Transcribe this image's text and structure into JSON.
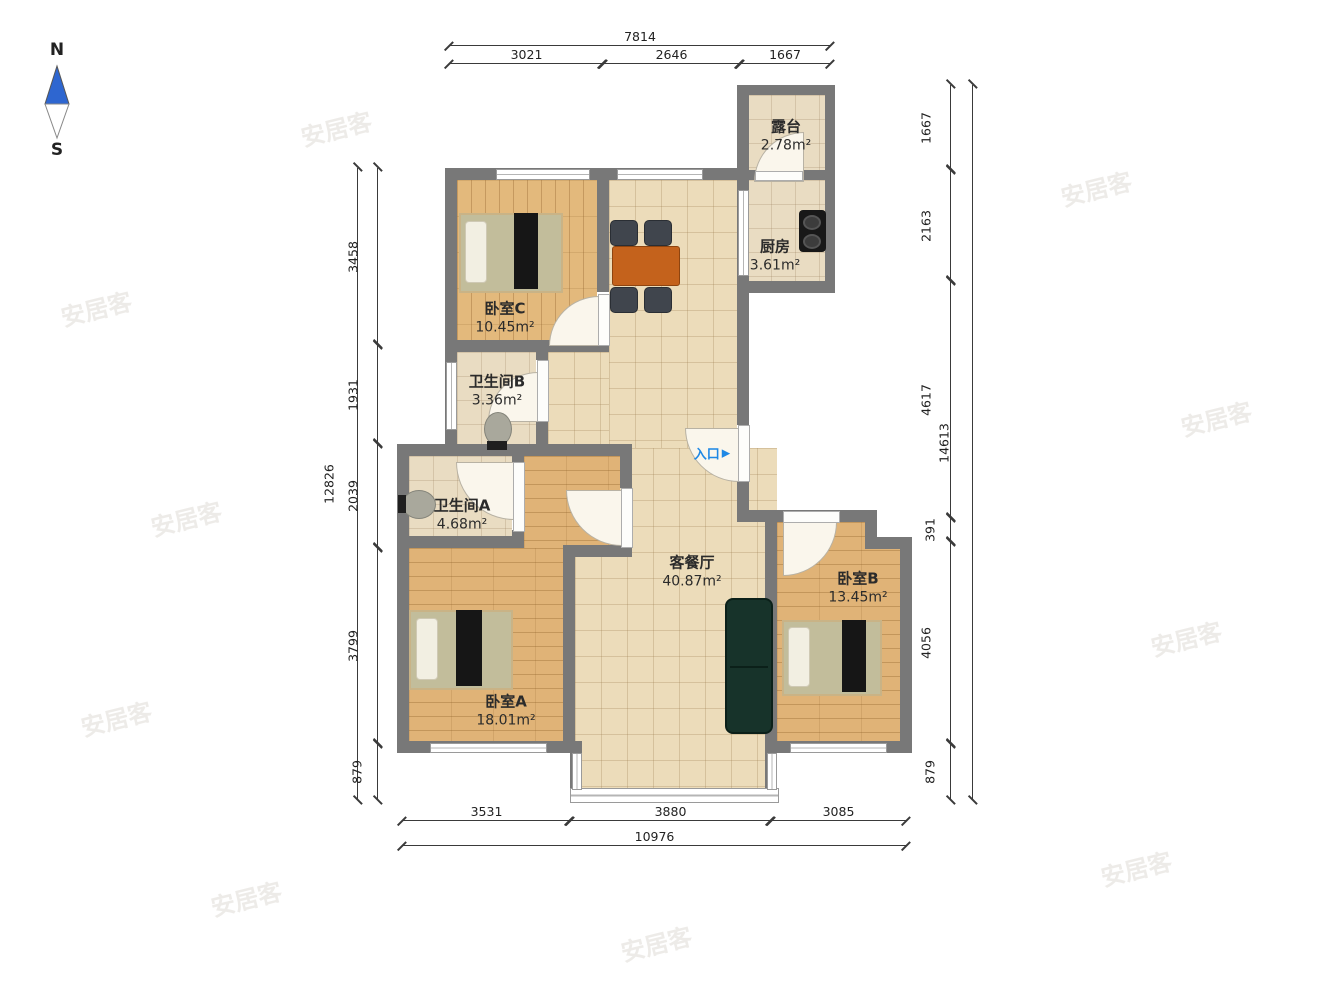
{
  "compass": {
    "north": "N",
    "south": "S"
  },
  "entrance": {
    "label": "入口",
    "arrow": "▶",
    "color": "#1e88e5"
  },
  "rooms": [
    {
      "id": "terrace",
      "name": "露台",
      "area": "2.78m²"
    },
    {
      "id": "kitchen",
      "name": "厨房",
      "area": "3.61m²"
    },
    {
      "id": "bedroomC",
      "name": "卧室C",
      "area": "10.45m²"
    },
    {
      "id": "bathB",
      "name": "卫生间B",
      "area": "3.36m²"
    },
    {
      "id": "bathA",
      "name": "卫生间A",
      "area": "4.68m²"
    },
    {
      "id": "living",
      "name": "客餐厅",
      "area": "40.87m²"
    },
    {
      "id": "bedroomB",
      "name": "卧室B",
      "area": "13.45m²"
    },
    {
      "id": "bedroomA",
      "name": "卧室A",
      "area": "18.01m²"
    }
  ],
  "dimensions": {
    "top": {
      "total": "7814",
      "segments": [
        "3021",
        "2646",
        "1667"
      ]
    },
    "bottom": {
      "total": "10976",
      "segments": [
        "3531",
        "3880",
        "3085"
      ]
    },
    "left": {
      "total": "12826",
      "segments": [
        "3458",
        "1931",
        "2039",
        "3799",
        "879"
      ]
    },
    "right": {
      "total": "14613",
      "segments": [
        "1667",
        "2163",
        "4617",
        "391",
        "4056",
        "879"
      ]
    }
  },
  "watermark": {
    "text": "安居客"
  },
  "colors": {
    "wall": "#787878",
    "tile_floor": "#ecdcba",
    "wood_floor": "#e3b97c",
    "entrance_blue": "#1e88e5",
    "sofa": "#17332a",
    "table": "#c4621c",
    "compass_blue": "#2e66d0"
  }
}
